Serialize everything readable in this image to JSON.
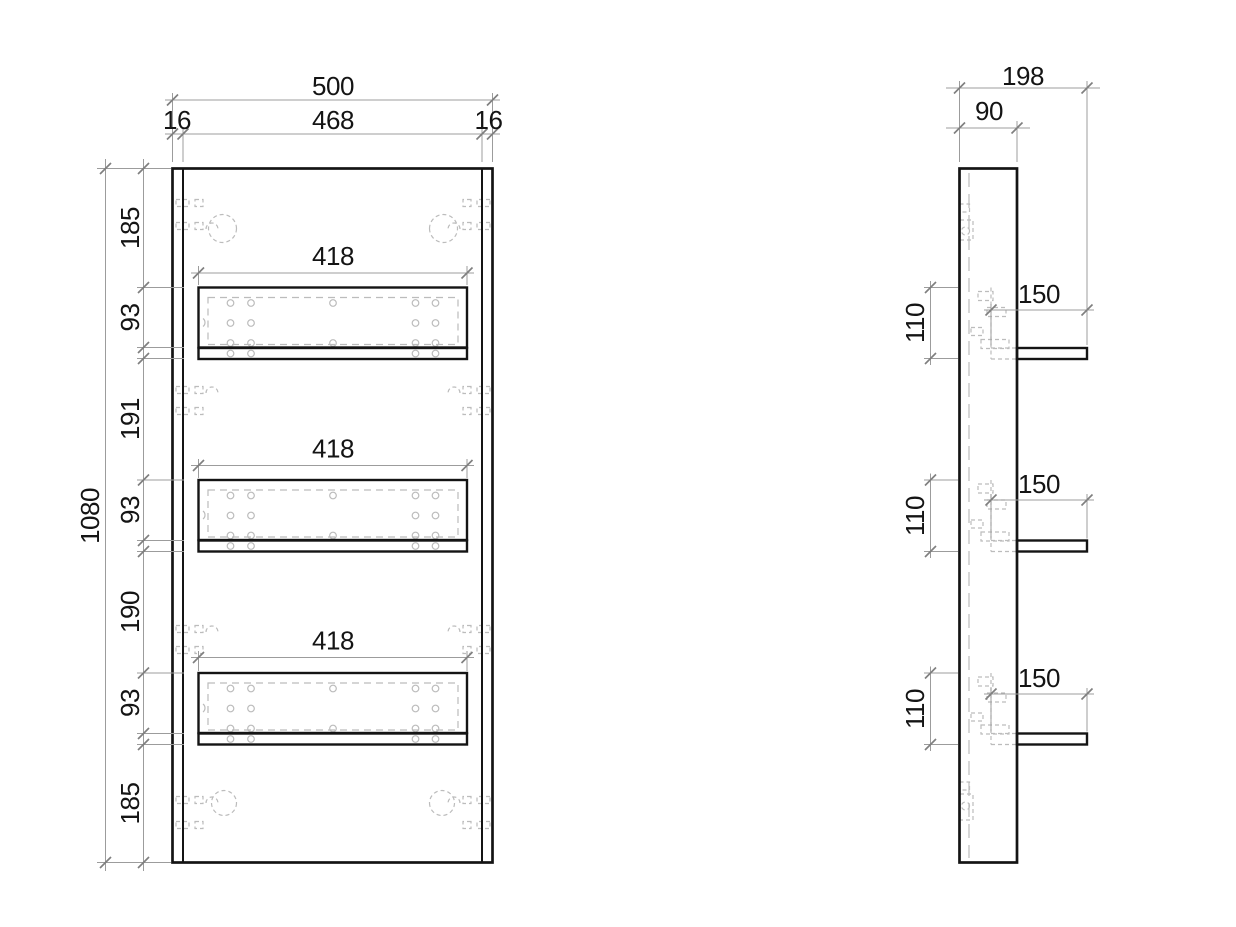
{
  "front": {
    "width_total": "500",
    "side_left": "16",
    "width_inner": "468",
    "side_right": "16",
    "height_total": "1080",
    "segments": [
      "185",
      "93",
      "191",
      "93",
      "190",
      "93",
      "185"
    ],
    "shelf_widths": [
      "418",
      "418",
      "418"
    ]
  },
  "side": {
    "depth_total": "198",
    "panel_depth": "90",
    "shelf_depths": [
      "150",
      "150",
      "150"
    ],
    "shelf_heights": [
      "110",
      "110",
      "110"
    ]
  },
  "colors": {
    "line": "#141414",
    "dim": "#9c9c9c",
    "tick": "#7f7f7f",
    "hidden": "#bcbcbc",
    "text": "#141414",
    "background": "#ffffff"
  }
}
